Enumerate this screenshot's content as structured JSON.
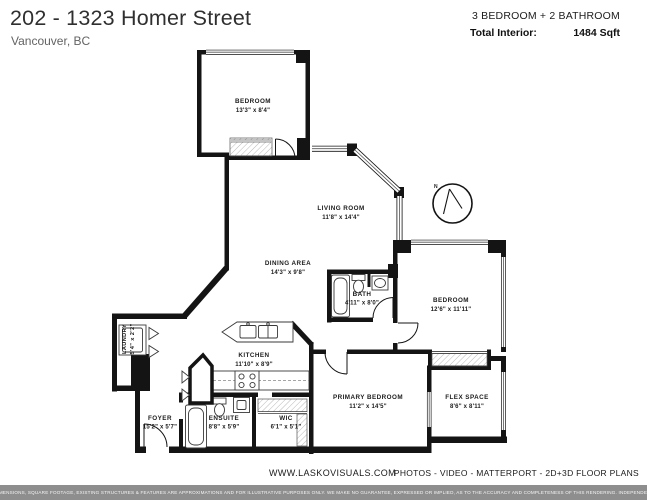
{
  "header": {
    "title": "202 - 1323 Homer Street",
    "subtitle": "Vancouver, BC",
    "bed_bath": "3 BEDROOM + 2 BATHROOM",
    "total_interior_label": "Total Interior:",
    "total_interior_value": "1484 Sqft"
  },
  "rooms": [
    {
      "id": "bedroom-top",
      "name": "BEDROOM",
      "dims": "13'3\" x 8'4\""
    },
    {
      "id": "living-room",
      "name": "LIVING ROOM",
      "dims": "11'8\" x 14'4\""
    },
    {
      "id": "dining-area",
      "name": "DINING AREA",
      "dims": "14'3\" x 9'8\""
    },
    {
      "id": "bath",
      "name": "BATH",
      "dims": "4'11\" x 8'0\""
    },
    {
      "id": "bedroom-right",
      "name": "BEDROOM",
      "dims": "12'6\" x 11'11\""
    },
    {
      "id": "laundry",
      "name": "LAUNDRY",
      "dims": "5'4\" x 2'2\""
    },
    {
      "id": "kitchen",
      "name": "KITCHEN",
      "dims": "11'10\" x 8'9\""
    },
    {
      "id": "foyer",
      "name": "FOYER",
      "dims": "15'2\" x 5'7\""
    },
    {
      "id": "ensuite",
      "name": "ENSUITE",
      "dims": "8'8\" x 5'9\""
    },
    {
      "id": "wic",
      "name": "WIC",
      "dims": "6'1\" x 5'1\""
    },
    {
      "id": "primary-bedroom",
      "name": "PRIMARY BEDROOM",
      "dims": "11'2\" x 14'5\""
    },
    {
      "id": "flex-space",
      "name": "FLEX SPACE",
      "dims": "8'6\" x 8'11\""
    }
  ],
  "compass": {
    "north": "N"
  },
  "footer": {
    "website": "WWW.LASKOVISUALS.COM",
    "services": "PHOTOS - VIDEO - MATTERPORT - 2D+3D FLOOR PLANS",
    "disclaimer": "FLOOR PLAN MEASUREMENTS, DIMENSIONS, SQUARE FOOTAGE, EXISTING STRUCTURES & FEATURES ARE APPROXIMATIONS AND FOR ILLUSTRATIVE PURPOSES ONLY. WE MAKE NO GUARANTEE, EXPRESSED OR IMPLIED, AS TO THE ACCURACY AND COMPLETENESS OF THIS RENDERING. INDEPENDENT VERIFICATION RECOMMENDED"
  },
  "colors": {
    "wall": "#141414",
    "disclaimer_bar": "#8e8e8e"
  }
}
